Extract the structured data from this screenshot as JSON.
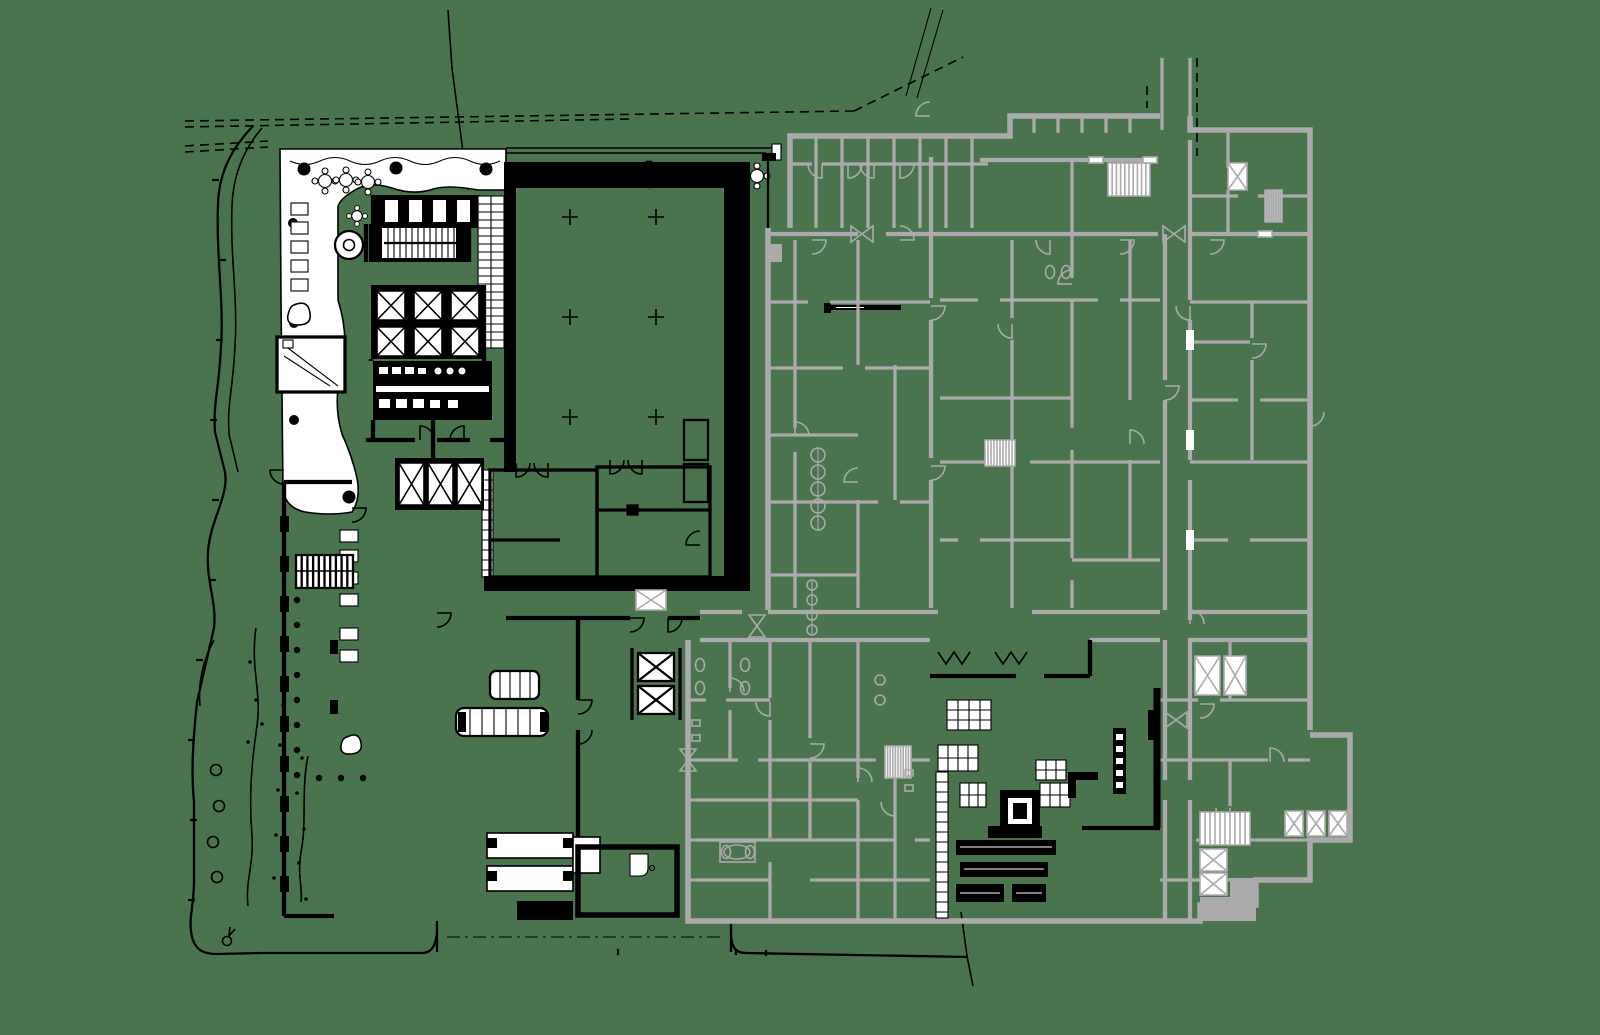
{
  "diagram": {
    "type": "architectural-floor-plan",
    "aria_label": "architectural-floor-plan",
    "visible_text": [],
    "features": {
      "new_building_ink": "black linework (lobby, terrace, cores, ballroom, kitchen fit-out)",
      "existing_building_ink": "gray linework (adjacent building rooms, corridors, elevators, stairs)",
      "site": "dashed property lines, curved site boundary, planting, entry drive, section leaders"
    }
  },
  "colors": {
    "background": "#4a744d",
    "ink": "#000000",
    "existing_gray": "#ababab",
    "paper": "#ffffff"
  }
}
